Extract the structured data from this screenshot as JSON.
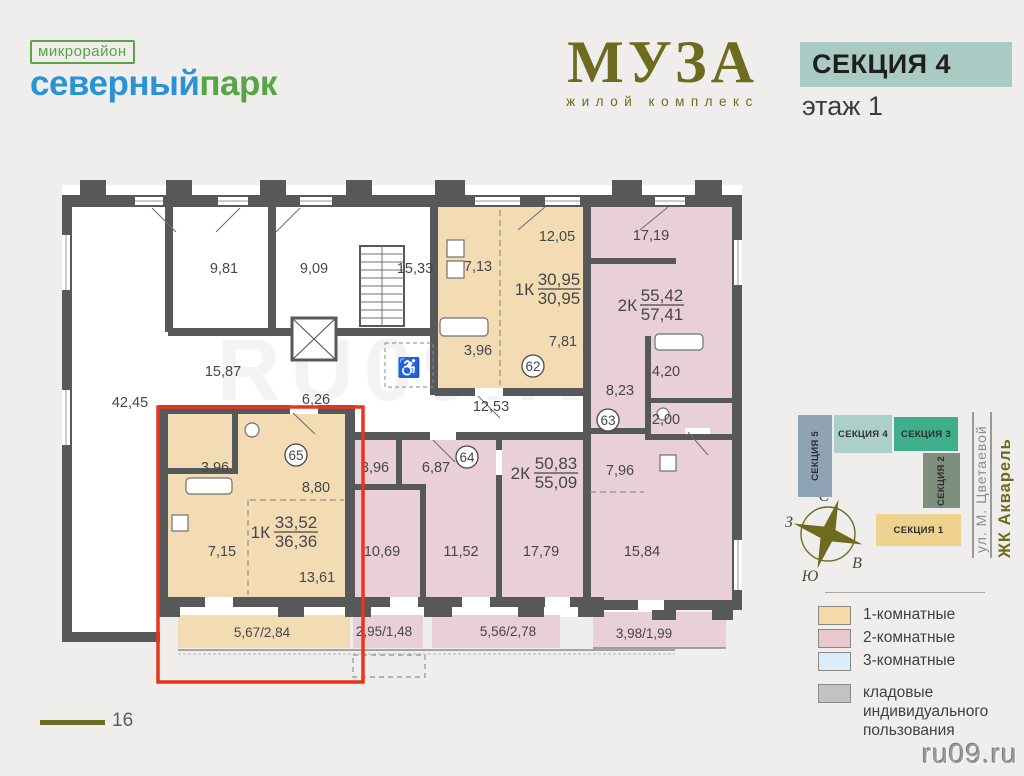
{
  "header": {
    "district_kicker": "микрорайон",
    "district_blue": "северный",
    "district_green": "парк",
    "complex_name": "МУЗА",
    "complex_subtitle": "жилой комплекс",
    "section_badge": "СЕКЦИЯ 4",
    "floor_label": "этаж 1"
  },
  "colors": {
    "wall": "#57585a",
    "one_room": "#f3dcb3",
    "two_room": "#e9cfd6",
    "three_room": "#d9edfa",
    "storage": "#c2c2c2",
    "highlight_red": "#e8351f",
    "accent_olive": "#6f6b1e",
    "badge_teal": "#a9cbc4"
  },
  "floorplan": {
    "common": {
      "r9_81": "9,81",
      "r9_09": "9,09",
      "r15_33": "15,33",
      "r15_87": "15,87",
      "r42_45": "42,45",
      "r6_26": "6,26",
      "r12_53": "12,53"
    },
    "apt62": {
      "number": "62",
      "type": "1К",
      "area_total": "30,95",
      "area_full": "30,95",
      "rooms": {
        "kitchen": "7,13",
        "bedroom": "12,05",
        "bath": "3,96",
        "hall": "7,81"
      }
    },
    "apt63": {
      "number": "63",
      "type": "2К",
      "area_total": "55,42",
      "area_full": "57,41",
      "rooms": {
        "bedroom": "17,19",
        "hall": "8,23",
        "bath": "4,20",
        "wc": "2,00",
        "kitchen": "7,96",
        "living": "15,84",
        "balcony": "3,98/1,99"
      }
    },
    "apt64": {
      "number": "64",
      "type": "2К",
      "area_total": "50,83",
      "area_full": "55,09",
      "rooms": {
        "bath": "3,96",
        "hall": "6,87",
        "room1": "10,69",
        "room2": "11,52",
        "room3": "17,79",
        "balcony1": "2,95/1,48",
        "balcony2": "5,56/2,78"
      }
    },
    "apt65": {
      "number": "65",
      "type": "1К",
      "area_total": "33,52",
      "area_full": "36,36",
      "rooms": {
        "bath": "3,96",
        "hall": "8,80",
        "kitchen": "7,15",
        "living": "13,61",
        "balcony": "5,67/2,84"
      }
    }
  },
  "minimap": {
    "sections": [
      {
        "label": "СЕКЦИЯ 5",
        "color": "#8ea4b4"
      },
      {
        "label": "СЕКЦИЯ 4",
        "color": "#abd0c9"
      },
      {
        "label": "СЕКЦИЯ 3",
        "color": "#3fae8c"
      },
      {
        "label": "СЕКЦИЯ 2",
        "color": "#7e8f7e"
      },
      {
        "label": "СЕКЦИЯ 1",
        "color": "#eed28d"
      }
    ],
    "street": "ул. М. Цветаевой",
    "complex": "ЖК Акварель"
  },
  "compass": {
    "n": "С",
    "s": "Ю",
    "w": "З",
    "e": "В"
  },
  "legend": {
    "items": [
      {
        "label": "1-комнатные",
        "color": "#f6d9a6"
      },
      {
        "label": "2-комнатные",
        "color": "#e9c7cf"
      },
      {
        "label": "3-комнатные",
        "color": "#d9edfa"
      },
      {
        "label": "кладовые индивидуального пользования",
        "color": "#c2c2c2"
      }
    ]
  },
  "footer": {
    "floor_mark": "16",
    "watermark": "ru09.ru"
  }
}
